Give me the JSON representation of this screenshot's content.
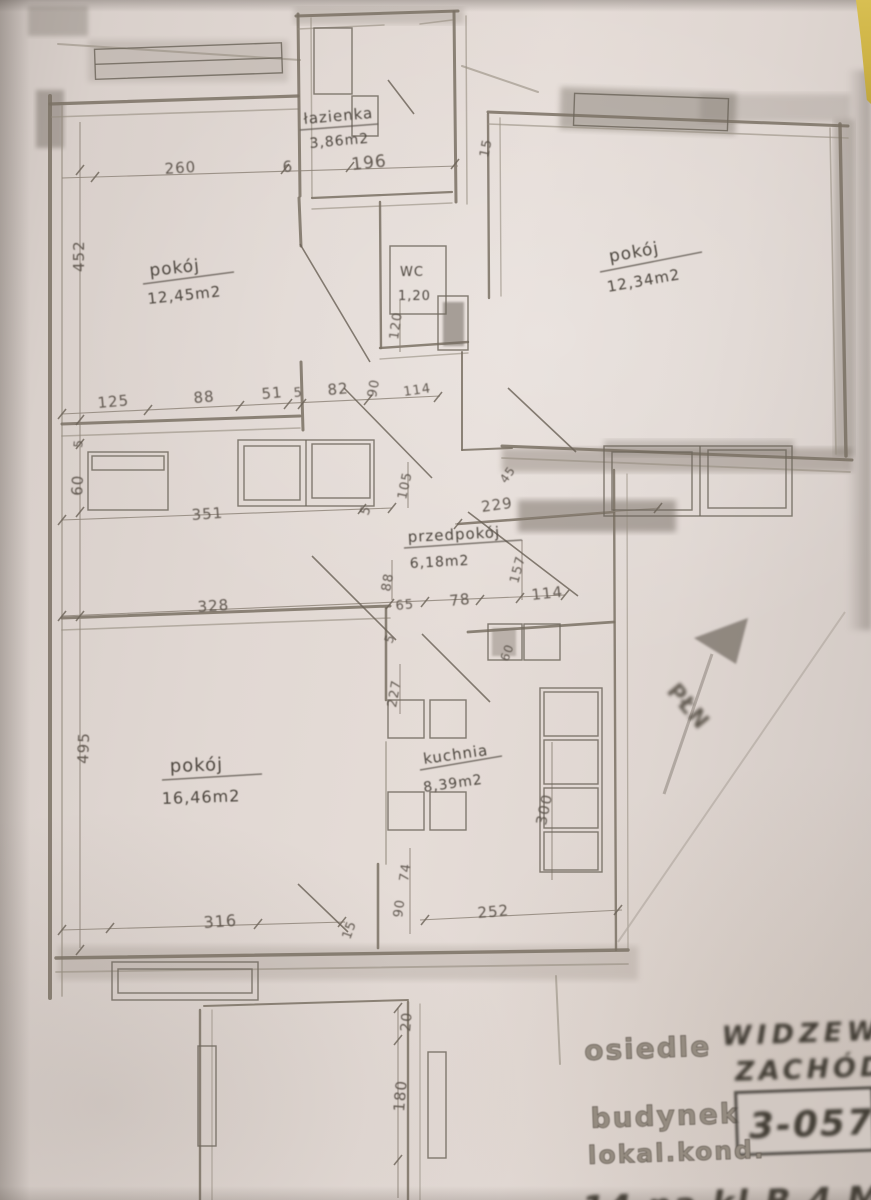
{
  "rooms": {
    "lazienka": {
      "name": "łazienka",
      "area": "3,86m2"
    },
    "pokoj_top_left": {
      "name": "pokój",
      "area": "12,45m2"
    },
    "pokoj_top_right": {
      "name": "pokój",
      "area": "12,34m2"
    },
    "wc": {
      "name": "WC",
      "area": "1,20"
    },
    "przedpokoj": {
      "name": "przedpokój",
      "area": "6,18m2"
    },
    "pokoj_bottom": {
      "name": "pokój",
      "area": "16,46m2"
    },
    "kuchnia": {
      "name": "kuchnia",
      "area": "8,39m2"
    }
  },
  "dims": {
    "d196": "196",
    "d260": "260",
    "d6": "6",
    "d15_top": "15",
    "d452": "452",
    "d5_left": "5",
    "d60_left": "60",
    "d125": "125",
    "d88_top": "88",
    "d51": "51",
    "d5_mid": "5",
    "d82": "82",
    "d90_mid": "90",
    "d114_mid": "114",
    "d120_wc": "120",
    "d105": "105",
    "d229": "229",
    "d157": "157",
    "d45": "45",
    "d351": "351",
    "d5_right": "5",
    "d328": "328",
    "d88_low": "88",
    "d65": "65",
    "d78": "78",
    "d114_low": "114",
    "d5_low": "5",
    "d227": "227",
    "d60_kitchen": "60",
    "d300": "300",
    "d495": "495",
    "d316": "316",
    "d15_bottom": "15",
    "d90_bottom": "90",
    "d74": "74",
    "d252": "252",
    "d20": "20",
    "d180": "180"
  },
  "north": {
    "label": "PŁN"
  },
  "title_block": {
    "osiedle_label": "osiedle",
    "osiedle_value_line1": "WIDZEW",
    "osiedle_value_line2": "ZACHÓD",
    "budynek_label": "budynek",
    "budynek_value": "3-057",
    "lokal_label": "lokal.kond.",
    "lokal_value_partial": "14 na kl.B.4 M.42"
  }
}
